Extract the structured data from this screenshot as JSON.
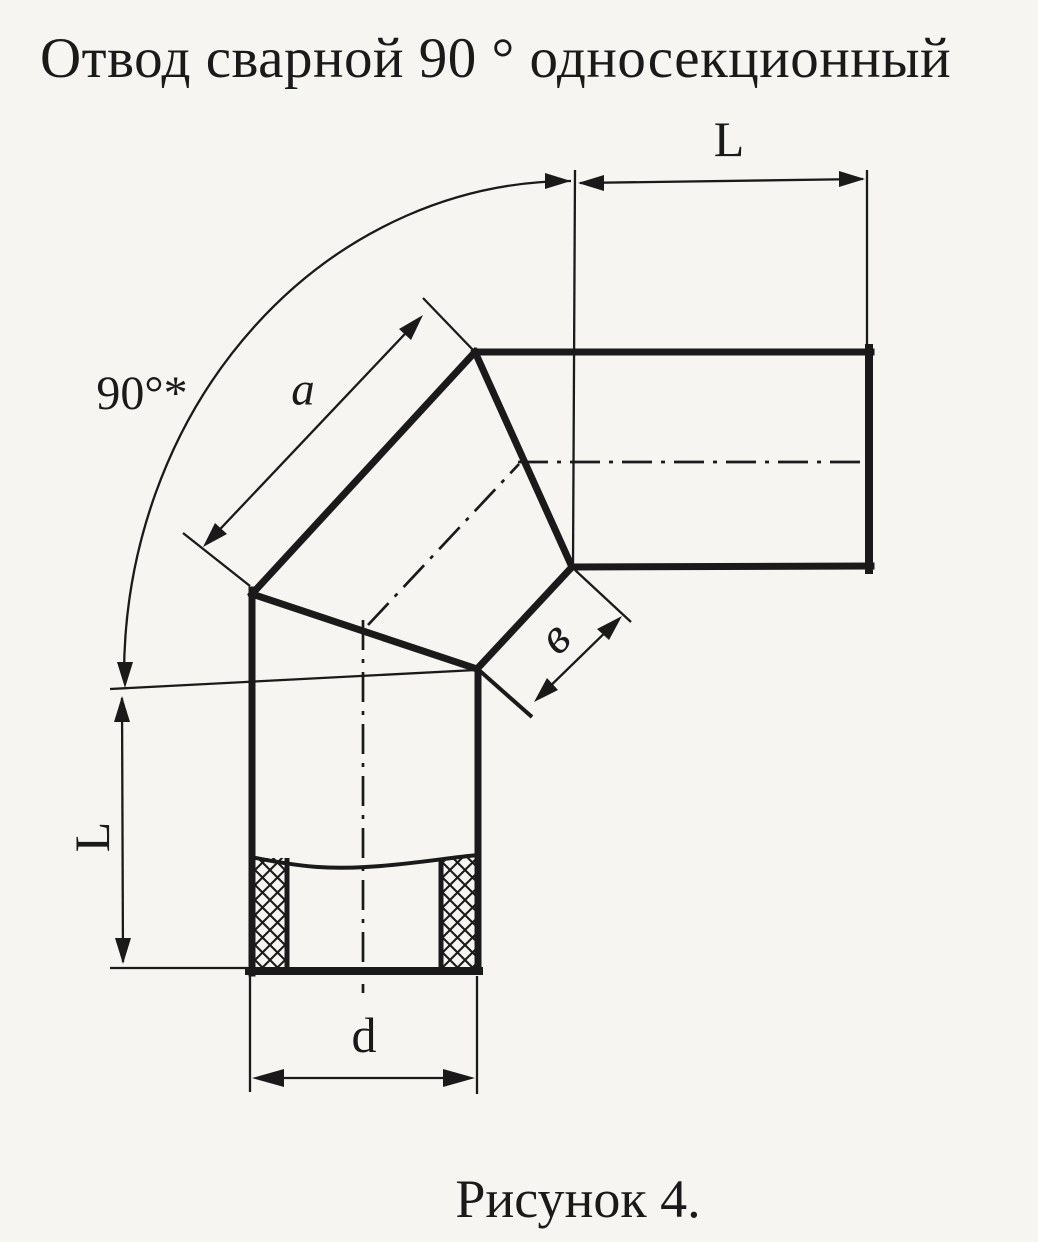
{
  "page": {
    "title": "Отвод сварной 90 ° односекционный",
    "caption": "Рисунок 4."
  },
  "drawing": {
    "labels": {
      "angle": "90°*",
      "length_a": "a",
      "width_b": "в",
      "length_L_top": "L",
      "length_L_left": "L",
      "diameter_d": "d"
    },
    "colors": {
      "ink": "#1a1a1a",
      "paper": "#f6f5f2"
    }
  }
}
